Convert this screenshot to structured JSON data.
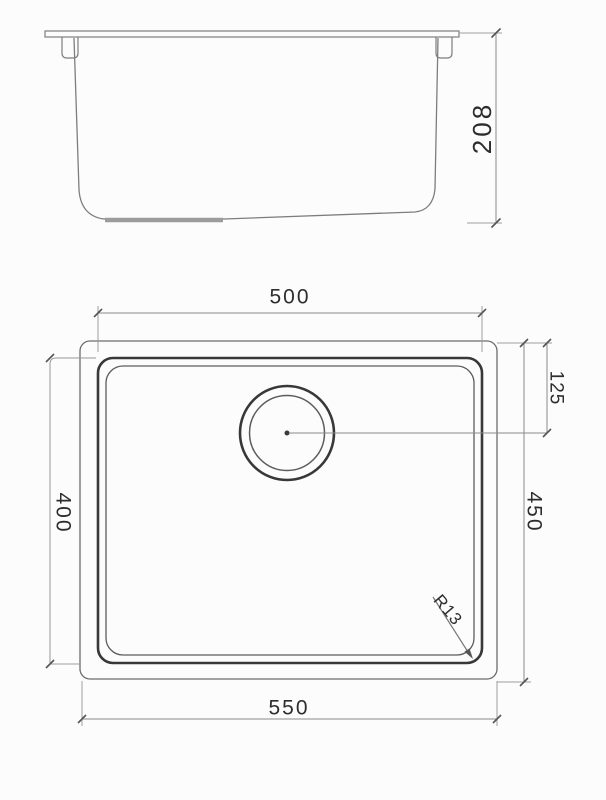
{
  "colors": {
    "line_dark": "#383838",
    "line_medium": "#6b6b6b",
    "line_light": "#999999",
    "pad_gray": "#9c9c9c",
    "dimension_text": "#2d2d2d",
    "background": "#fcfcfc"
  },
  "side_view": {
    "height_label": "208"
  },
  "plan_view": {
    "bowl_width_label": "500",
    "overall_width_label": "550",
    "bowl_length_label": "400",
    "overall_length_label": "450",
    "drain_offset_label": "125",
    "corner_radius_label": "R13"
  }
}
